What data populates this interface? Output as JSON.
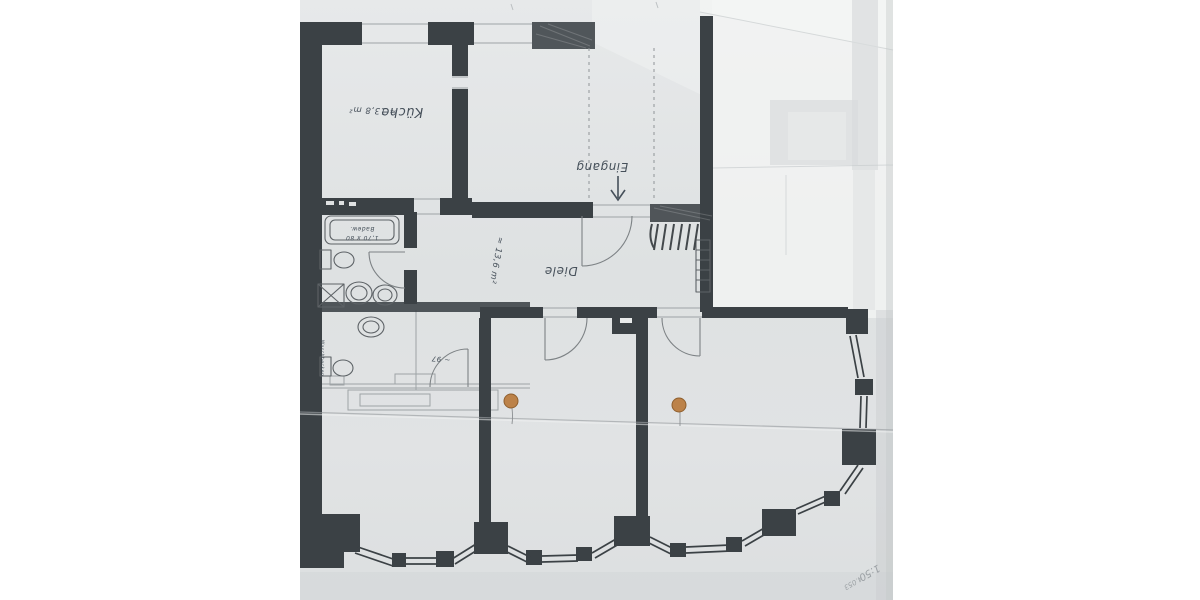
{
  "photo": {
    "type": "floor-plan photograph",
    "orientation": "rotated-180-degrees",
    "language": "German"
  },
  "labels": {
    "kueche": "Küche",
    "kueche_area": "≈ 13,8 m²",
    "eingang": "Eingang",
    "diele": "Diele",
    "diele_area": "≈ 13,6 m²",
    "tub_line1": "Badew.",
    "tub_line2": "1,70 x 80",
    "bath_note": "~ 97",
    "bath_side_note": "Waschbecken",
    "scale_note": "1:50",
    "ref_note": "4.053"
  },
  "markers": {
    "orange_dot_count": 2
  },
  "colors": {
    "background": "#ffffff",
    "paper": "#e2e4e5",
    "paper_bright": "#f4f5f4",
    "wall": "#3b4145",
    "pencil": "#5d6266",
    "ink": "#46505a",
    "marker_dot": "#bc8249",
    "marker_dot_edge": "#8f5f2e",
    "crease": "#9a9ea1"
  }
}
